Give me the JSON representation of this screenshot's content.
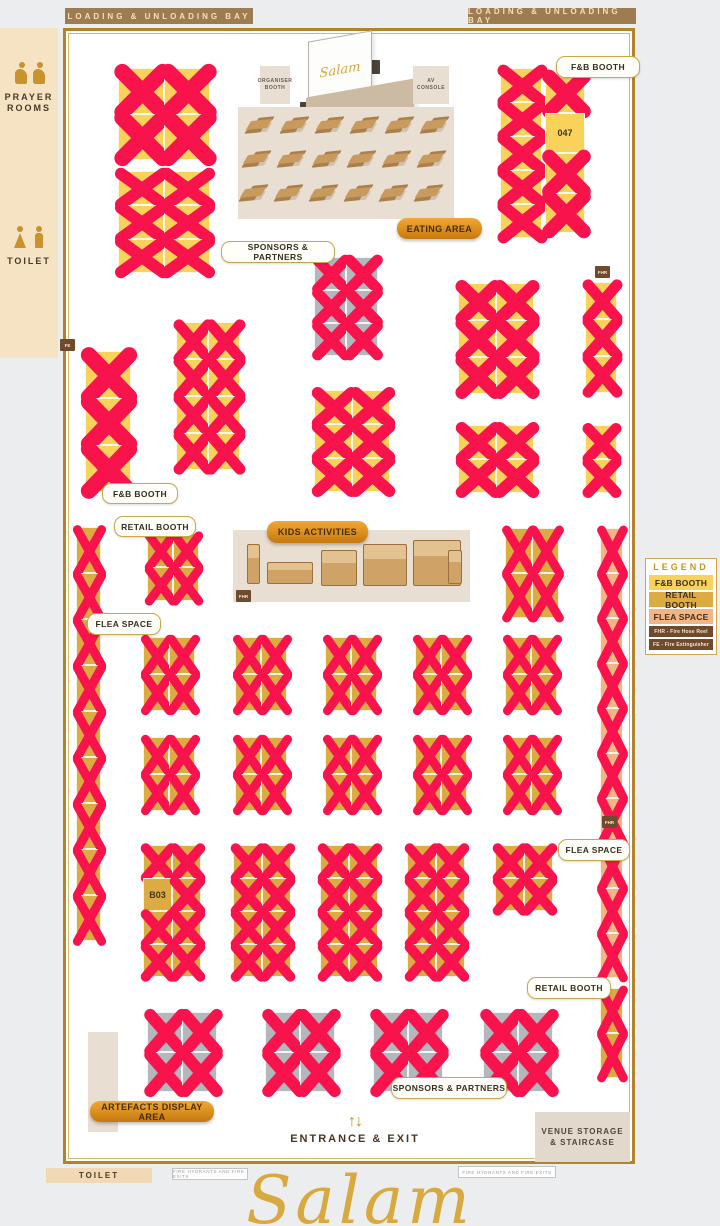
{
  "palette": {
    "gold": "#b3832a",
    "fnb": "#f9d25c",
    "retail": "#dcab42",
    "flea": "#f4b585",
    "sponsor": "#b4b7bb",
    "xmark": "#f8134d",
    "marker_brown": "#6f4a2d",
    "bar_brown": "#9d7c52",
    "script_gold": "#d7a93e"
  },
  "loading_bays": {
    "left": "LOADING & UNLOADING BAY",
    "right": "LOADING & UNLOADING BAY"
  },
  "sidebar": {
    "prayer_rooms": "PRAYER ROOMS",
    "toilet": "TOILET"
  },
  "stage": {
    "screen_logo": "Salam",
    "organiser_booth": "ORGANISER BOOTH",
    "av_console": "AV CONSOLE"
  },
  "eating_area": {
    "label": "EATING AREA",
    "table_rows": 3,
    "table_cols": 6
  },
  "kids_area": {
    "label": "KIDS ACTIVITIES",
    "toys": [
      "claw-machine",
      "sandbox",
      "play-pen",
      "bounce-house",
      "bounce-castle",
      "arcade-machine"
    ]
  },
  "legend": {
    "title": "LEGEND",
    "items": [
      {
        "label": "F&B BOOTH",
        "bg": "#f9d25c",
        "fg": "#3d3020",
        "small": false
      },
      {
        "label": "RETAIL BOOTH",
        "bg": "#dcab42",
        "fg": "#3d3020",
        "small": false
      },
      {
        "label": "FLEA SPACE",
        "bg": "#f4b585",
        "fg": "#3d3020",
        "small": false
      },
      {
        "label": "FHR - Fire Hose Reel",
        "bg": "#6f4a2d",
        "fg": "#f4e7d2",
        "small": true
      },
      {
        "label": "FE - Fire Extinguisher",
        "bg": "#6f4a2d",
        "fg": "#f4e7d2",
        "small": true
      }
    ]
  },
  "pills": [
    {
      "id": "fnb-booth-label-top",
      "label": "F&B BOOTH",
      "style": "white",
      "x": 556,
      "y": 56,
      "w": 82,
      "h": 20
    },
    {
      "id": "sponsors-partners-label-top",
      "label": "SPONSORS & PARTNERS",
      "style": "white",
      "x": 221,
      "y": 241,
      "w": 112,
      "h": 20
    },
    {
      "id": "eating-area-label",
      "label": "EATING AREA",
      "style": "gold",
      "x": 397,
      "y": 218,
      "w": 85,
      "h": 21
    },
    {
      "id": "fnb-booth-label-left",
      "label": "F&B BOOTH",
      "style": "white",
      "x": 102,
      "y": 483,
      "w": 74,
      "h": 19
    },
    {
      "id": "retail-booth-label-left",
      "label": "RETAIL BOOTH",
      "style": "white",
      "x": 114,
      "y": 516,
      "w": 80,
      "h": 19
    },
    {
      "id": "kids-activities-label",
      "label": "KIDS ACTIVITIES",
      "style": "gold",
      "x": 267,
      "y": 521,
      "w": 101,
      "h": 22
    },
    {
      "id": "flea-space-label-left",
      "label": "FLEA SPACE",
      "style": "white",
      "x": 87,
      "y": 613,
      "w": 72,
      "h": 20
    },
    {
      "id": "flea-space-label-right",
      "label": "FLEA SPACE",
      "style": "white",
      "x": 558,
      "y": 839,
      "w": 70,
      "h": 20
    },
    {
      "id": "retail-booth-label-right",
      "label": "RETAIL BOOTH",
      "style": "white",
      "x": 527,
      "y": 977,
      "w": 82,
      "h": 20
    },
    {
      "id": "sponsors-partners-label-bottom",
      "label": "SPONSORS & PARTNERS",
      "style": "white",
      "x": 391,
      "y": 1077,
      "w": 114,
      "h": 20
    },
    {
      "id": "artefacts-display-area-label",
      "label": "ARTEFACTS DISPLAY AREA",
      "style": "gold",
      "x": 90,
      "y": 1101,
      "w": 124,
      "h": 21
    }
  ],
  "markers": [
    {
      "label": "FE",
      "x": 60,
      "y": 339
    },
    {
      "label": "FHR",
      "x": 595,
      "y": 266
    },
    {
      "label": "FHR",
      "x": 236,
      "y": 590
    },
    {
      "label": "FHR",
      "x": 602,
      "y": 816
    }
  ],
  "booth_groups": [
    {
      "id": "fnb-topleft-a",
      "type": "fnb",
      "x": 118,
      "y": 68,
      "cols": 2,
      "rows": 2,
      "cw": 46,
      "ch": 46
    },
    {
      "id": "fnb-topleft-b",
      "type": "fnb",
      "x": 118,
      "y": 171,
      "cols": 2,
      "rows": 3,
      "cw": 46,
      "ch": 34
    },
    {
      "id": "fnb-topright-long",
      "type": "fnb",
      "x": 500,
      "y": 68,
      "cols": 1,
      "rows": 5,
      "cw": 42,
      "ch": 34
    },
    {
      "id": "fnb-topright-047",
      "type": "fnb",
      "x": 545,
      "y": 73,
      "cols": 1,
      "rows": 4,
      "cw": 40,
      "ch": 40,
      "open": [
        {
          "index": 1,
          "label": "047"
        }
      ]
    },
    {
      "id": "sponsor-top",
      "type": "sponsor",
      "x": 314,
      "y": 257,
      "cols": 2,
      "rows": 3,
      "cw": 32,
      "ch": 33
    },
    {
      "id": "fnb-mid-left",
      "type": "fnb",
      "x": 85,
      "y": 351,
      "cols": 1,
      "rows": 3,
      "cw": 46,
      "ch": 47
    },
    {
      "id": "fnb-mid-b",
      "type": "fnb",
      "x": 176,
      "y": 322,
      "cols": 2,
      "rows": 4,
      "cw": 32,
      "ch": 37
    },
    {
      "id": "fnb-center",
      "type": "fnb",
      "x": 314,
      "y": 390,
      "cols": 2,
      "rows": 3,
      "cw": 38,
      "ch": 34
    },
    {
      "id": "fnb-rightcenter-up",
      "type": "fnb",
      "x": 458,
      "y": 283,
      "cols": 2,
      "rows": 3,
      "cw": 38,
      "ch": 37
    },
    {
      "id": "fnb-rightcenter-low",
      "type": "fnb",
      "x": 458,
      "y": 425,
      "cols": 2,
      "rows": 2,
      "cw": 38,
      "ch": 34
    },
    {
      "id": "fnb-right-single-up",
      "type": "fnb",
      "x": 585,
      "y": 282,
      "cols": 1,
      "rows": 3,
      "cw": 32,
      "ch": 37
    },
    {
      "id": "fnb-right-single-low",
      "type": "fnb",
      "x": 585,
      "y": 425,
      "cols": 1,
      "rows": 2,
      "cw": 32,
      "ch": 34
    },
    {
      "id": "retail-left-strip",
      "type": "retail",
      "x": 76,
      "y": 527,
      "cols": 1,
      "rows": 9,
      "cw": 25,
      "ch": 46
    },
    {
      "id": "retail-center-block",
      "type": "retail",
      "x": 147,
      "y": 533,
      "cols": 2,
      "rows": 2,
      "cw": 26,
      "ch": 34
    },
    {
      "id": "retail-right-pair",
      "type": "retail",
      "x": 505,
      "y": 528,
      "cols": 2,
      "rows": 2,
      "cw": 27,
      "ch": 45
    },
    {
      "id": "flea-right-strip",
      "type": "flea",
      "x": 600,
      "y": 528,
      "cols": 1,
      "rows": 10,
      "cw": 23,
      "ch": 45
    },
    {
      "id": "retail-right-bottom",
      "type": "retail",
      "x": 600,
      "y": 988,
      "cols": 1,
      "rows": 2,
      "cw": 23,
      "ch": 45
    },
    {
      "id": "retail-grid-a1",
      "type": "retail",
      "x": 143,
      "y": 637,
      "cols": 2,
      "rows": 2,
      "cw": 26,
      "ch": 37
    },
    {
      "id": "retail-grid-a2",
      "type": "retail",
      "x": 235,
      "y": 637,
      "cols": 2,
      "rows": 2,
      "cw": 26,
      "ch": 37
    },
    {
      "id": "retail-grid-a3",
      "type": "retail",
      "x": 325,
      "y": 637,
      "cols": 2,
      "rows": 2,
      "cw": 26,
      "ch": 37
    },
    {
      "id": "retail-grid-a4",
      "type": "retail",
      "x": 415,
      "y": 637,
      "cols": 2,
      "rows": 2,
      "cw": 26,
      "ch": 37
    },
    {
      "id": "retail-grid-a5",
      "type": "retail",
      "x": 505,
      "y": 637,
      "cols": 2,
      "rows": 2,
      "cw": 26,
      "ch": 37
    },
    {
      "id": "retail-grid-b1",
      "type": "retail",
      "x": 143,
      "y": 737,
      "cols": 2,
      "rows": 2,
      "cw": 26,
      "ch": 37
    },
    {
      "id": "retail-grid-b2",
      "type": "retail",
      "x": 235,
      "y": 737,
      "cols": 2,
      "rows": 2,
      "cw": 26,
      "ch": 37
    },
    {
      "id": "retail-grid-b3",
      "type": "retail",
      "x": 325,
      "y": 737,
      "cols": 2,
      "rows": 2,
      "cw": 26,
      "ch": 37
    },
    {
      "id": "retail-grid-b4",
      "type": "retail",
      "x": 415,
      "y": 737,
      "cols": 2,
      "rows": 2,
      "cw": 26,
      "ch": 37
    },
    {
      "id": "retail-grid-b5",
      "type": "retail",
      "x": 505,
      "y": 737,
      "cols": 2,
      "rows": 2,
      "cw": 26,
      "ch": 37
    },
    {
      "id": "retail-grid-c1",
      "type": "retail",
      "x": 143,
      "y": 845,
      "cols": 2,
      "rows": 4,
      "cw": 29,
      "ch": 33,
      "open": [
        {
          "index": 2,
          "label": "B03"
        }
      ]
    },
    {
      "id": "retail-grid-c2",
      "type": "retail",
      "x": 233,
      "y": 845,
      "cols": 2,
      "rows": 4,
      "cw": 29,
      "ch": 33
    },
    {
      "id": "retail-grid-c3",
      "type": "retail",
      "x": 320,
      "y": 845,
      "cols": 2,
      "rows": 4,
      "cw": 29,
      "ch": 33
    },
    {
      "id": "retail-grid-c4",
      "type": "retail",
      "x": 407,
      "y": 845,
      "cols": 2,
      "rows": 4,
      "cw": 29,
      "ch": 33
    },
    {
      "id": "retail-grid-c5",
      "type": "retail",
      "x": 495,
      "y": 845,
      "cols": 2,
      "rows": 2,
      "cw": 29,
      "ch": 33
    },
    {
      "id": "sponsor-bottom-1",
      "type": "sponsor",
      "x": 147,
      "y": 1012,
      "cols": 2,
      "rows": 2,
      "cw": 35,
      "ch": 40
    },
    {
      "id": "sponsor-bottom-2",
      "type": "sponsor",
      "x": 265,
      "y": 1012,
      "cols": 2,
      "rows": 2,
      "cw": 35,
      "ch": 40
    },
    {
      "id": "sponsor-bottom-3",
      "type": "sponsor",
      "x": 373,
      "y": 1012,
      "cols": 2,
      "rows": 2,
      "cw": 35,
      "ch": 40
    },
    {
      "id": "sponsor-bottom-4",
      "type": "sponsor",
      "x": 483,
      "y": 1012,
      "cols": 2,
      "rows": 2,
      "cw": 35,
      "ch": 40
    }
  ],
  "entrance": {
    "arrow_up": "↑",
    "arrow_down": "↓",
    "label": "ENTRANCE & EXIT"
  },
  "venue_storage": {
    "label": "VENUE STORAGE\n& STAIRCASE"
  },
  "footer": {
    "toilet": "TOILET",
    "fire_note_left": "FIRE HYDRANTS AND FIRE EXITS",
    "fire_note_right": "FIRE HYDRANTS AND FIRE EXITS",
    "brand_script": "Salam"
  }
}
